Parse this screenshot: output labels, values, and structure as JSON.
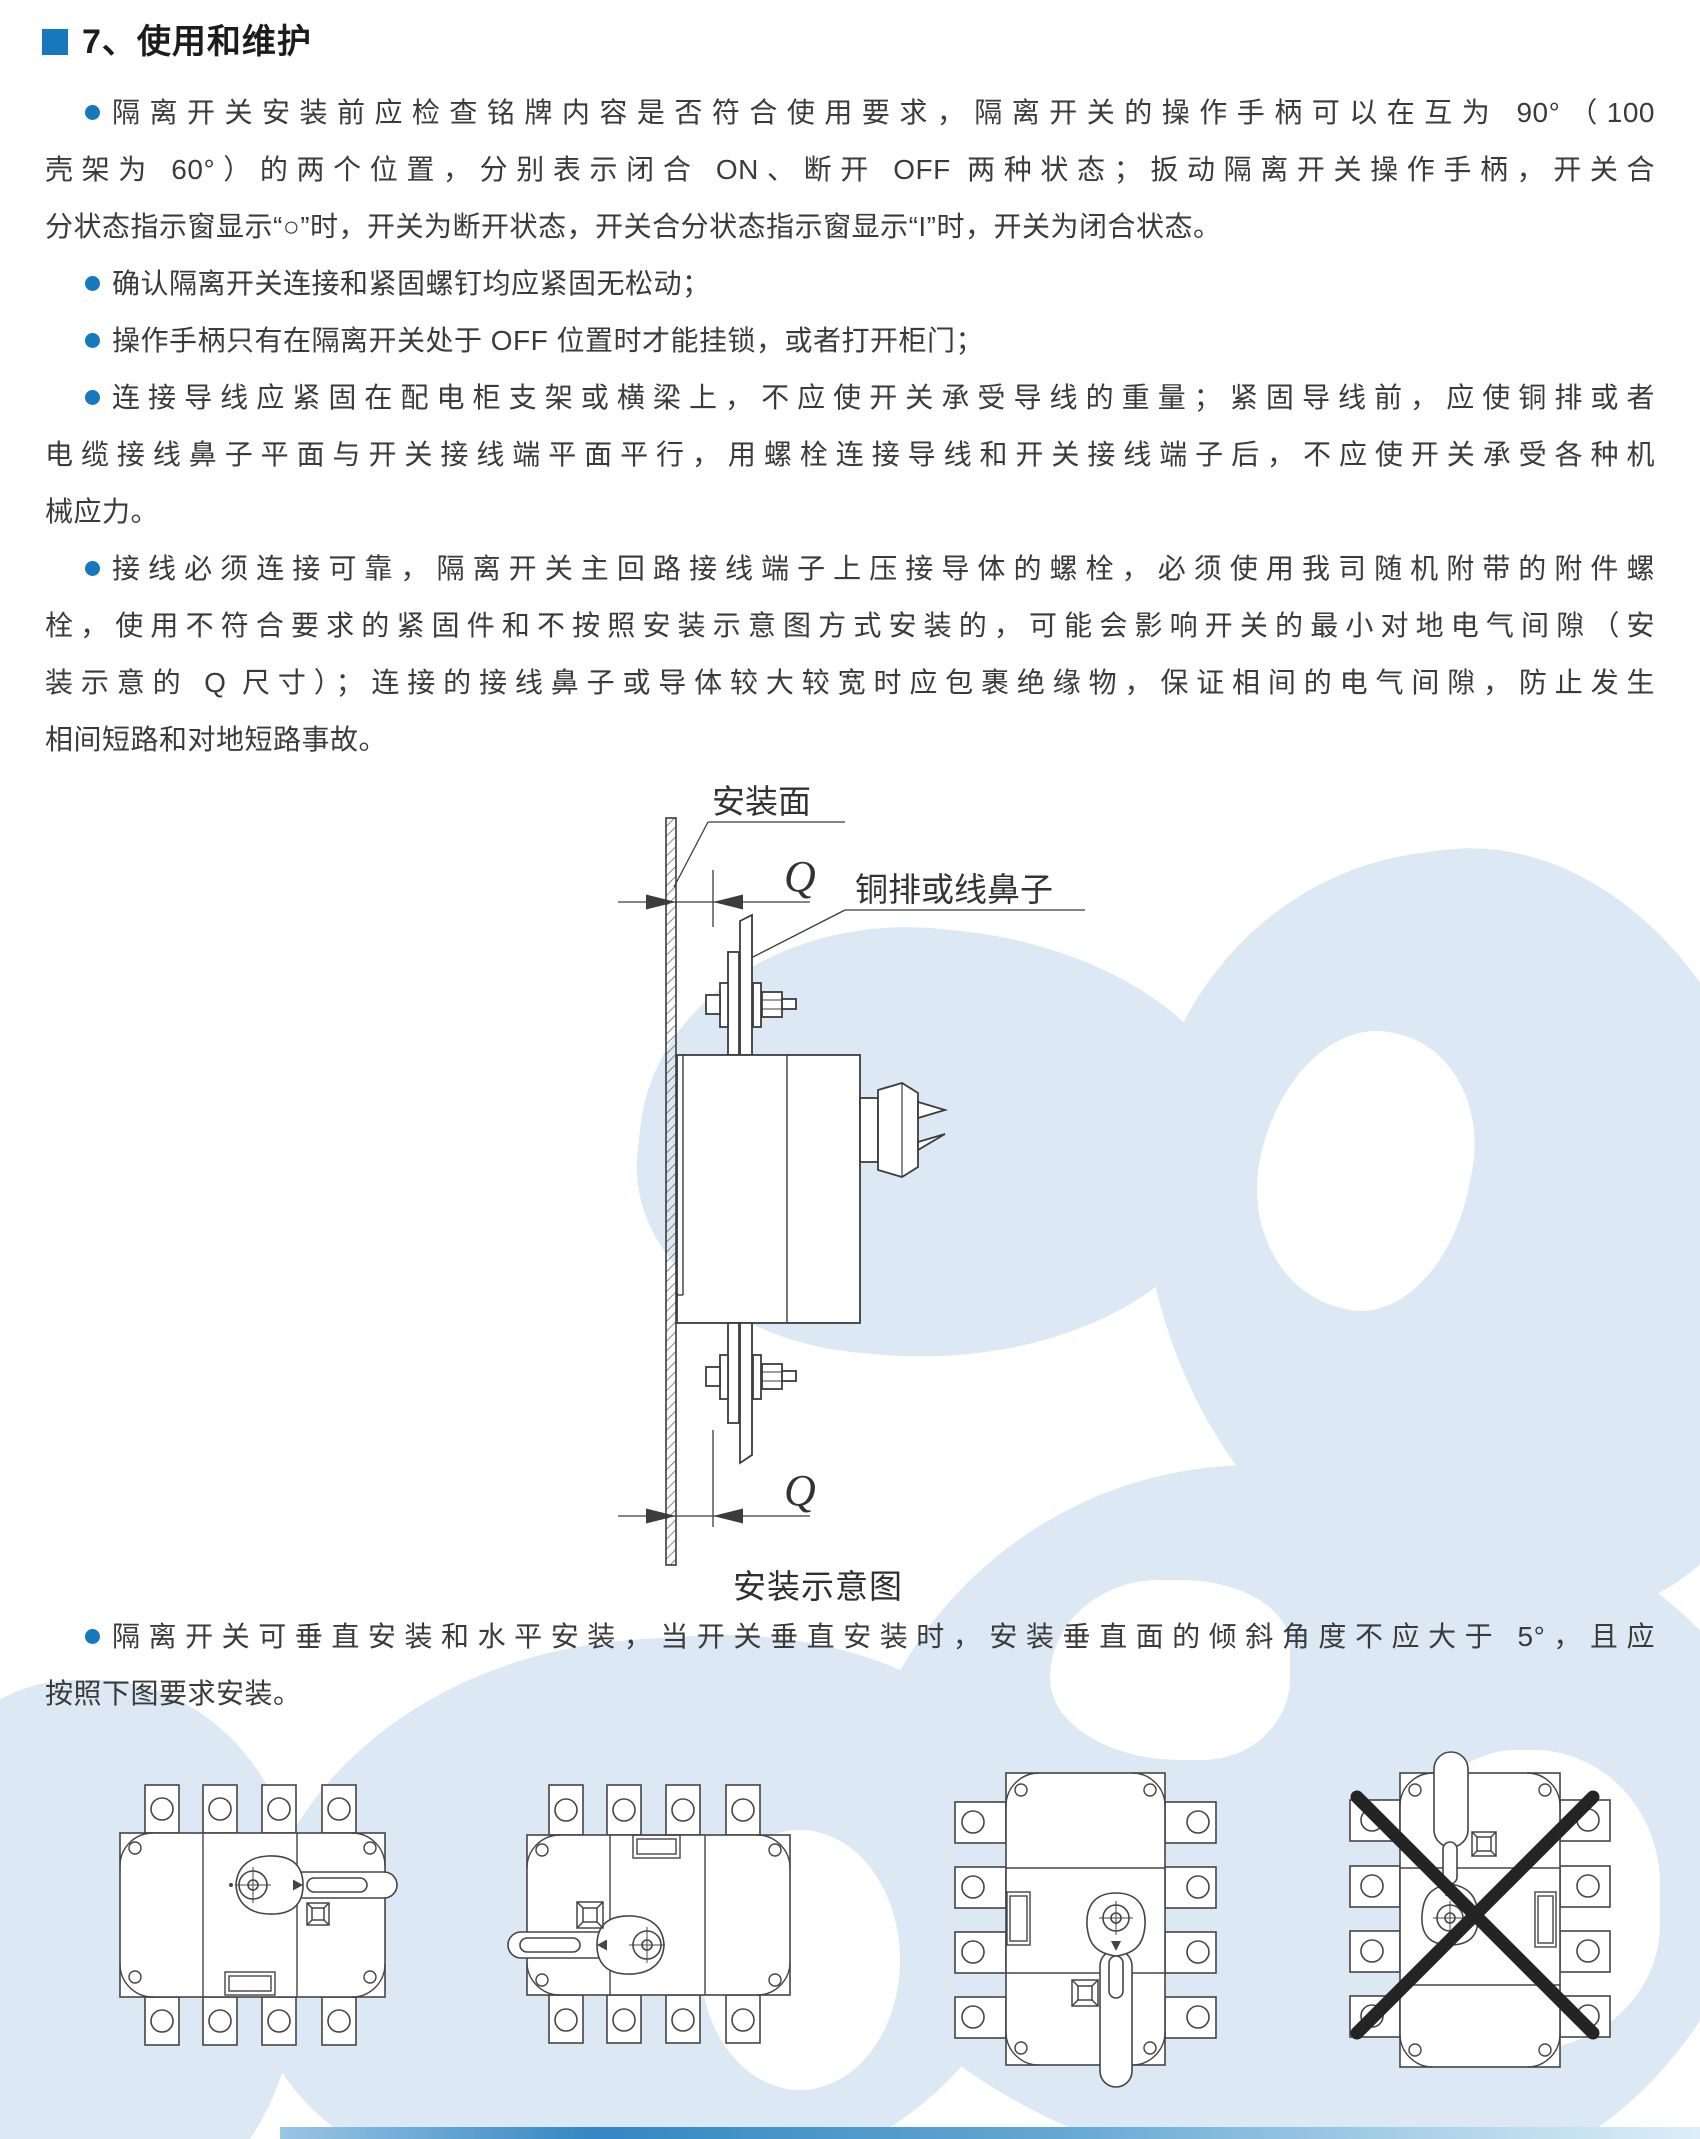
{
  "page": {
    "heading": "7、使用和维护",
    "accent_color": "#1878be",
    "text_color": "#3b3b3b"
  },
  "paragraphs": [
    {
      "lines": [
        "隔离开关安装前应检查铭牌内容是否符合使用要求，隔离开关的操作手柄可以在互为 90°（100",
        "壳架为 60°）的两个位置，分别表示闭合 ON、断开 OFF 两种状态；扳动隔离开关操作手柄，开关合",
        "分状态指示窗显示“○”时，开关为断开状态，开关合分状态指示窗显示“I”时，开关为闭合状态。"
      ]
    },
    {
      "lines": [
        "确认隔离开关连接和紧固螺钉均应紧固无松动；"
      ]
    },
    {
      "lines": [
        "操作手柄只有在隔离开关处于 OFF 位置时才能挂锁，或者打开柜门；"
      ]
    },
    {
      "lines": [
        "连接导线应紧固在配电柜支架或横梁上，不应使开关承受导线的重量；紧固导线前，应使铜排或者",
        "电缆接线鼻子平面与开关接线端平面平行，用螺栓连接导线和开关接线端子后，不应使开关承受各种机",
        "械应力。"
      ]
    },
    {
      "lines": [
        "接线必须连接可靠，隔离开关主回路接线端子上压接导体的螺栓，必须使用我司随机附带的附件螺",
        "栓，使用不符合要求的紧固件和不按照安装示意图方式安装的，可能会影响开关的最小对地电气间隙（安",
        "装示意的 Q 尺寸）；连接的接线鼻子或导体较大较宽时应包裹绝缘物，保证相间的电气间隙，防止发生",
        "相间短路和对地短路事故。"
      ]
    },
    {
      "lines": [
        "隔离开关可垂直安装和水平安装，当开关垂直安装时，安装垂直面的倾斜角度不应大于 5°，且应",
        "按照下图要求安装。"
      ]
    }
  ],
  "diagram": {
    "mounting_surface_label": "安装面",
    "busbar_label": "铜排或线鼻子",
    "dimension_label": "Q",
    "caption": "安装示意图"
  }
}
